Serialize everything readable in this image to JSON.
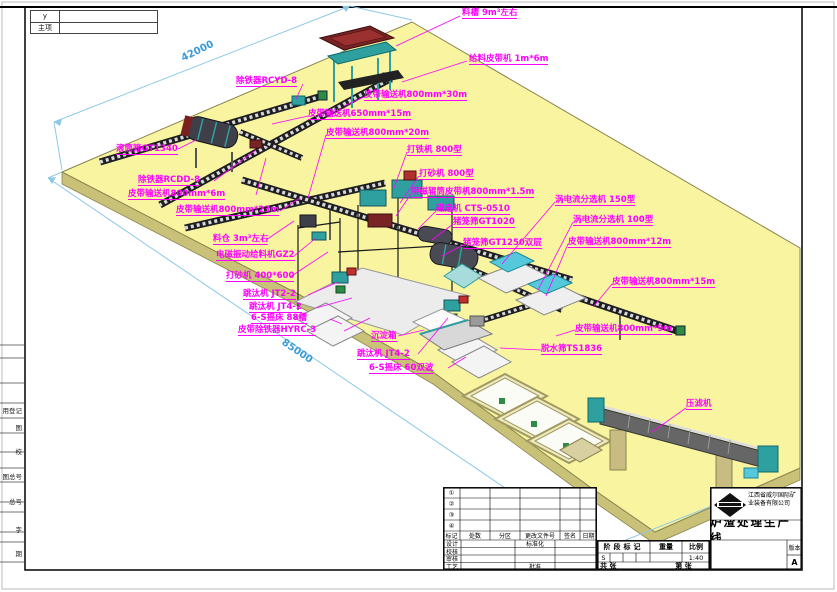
{
  "colors": {
    "platform": "#F8F4A0",
    "platform_edge": "#C9C178",
    "label": "#FF00FF",
    "dimension_text": "#3A9AD9",
    "dimension_line": "#8CC8E8",
    "machine_teal": "#2FA0A0",
    "machine_cyan": "#55C8DC",
    "machine_darkred": "#7A2525",
    "conveyor": "#1E1E22"
  },
  "corner_box": {
    "row1": "y",
    "row2": "主项"
  },
  "margin_fields": [
    {
      "text": "用登记",
      "y": 405
    },
    {
      "text": "图",
      "y": 422
    },
    {
      "text": "校",
      "y": 446
    },
    {
      "text": "图总号",
      "y": 471
    },
    {
      "text": "总号",
      "y": 496
    },
    {
      "text": "字",
      "y": 524
    },
    {
      "text": "期",
      "y": 548
    }
  ],
  "dimensions": {
    "top_edge": "42000",
    "bottom_edge": "85000"
  },
  "annotations": [
    {
      "name": "label-feed-trough",
      "text": "料槽 9m³左右",
      "x": 462,
      "y": 9
    },
    {
      "name": "label-feed-belt",
      "text": "给料皮带机 1m*6m",
      "x": 469,
      "y": 55
    },
    {
      "name": "label-iron-remover-rcyd8",
      "text": "除铁器RCYD-8",
      "x": 236,
      "y": 77
    },
    {
      "name": "label-belt-800-30",
      "text": "皮带输送机800mm*30m",
      "x": 364,
      "y": 91
    },
    {
      "name": "label-belt-650-15",
      "text": "皮带输送机650mm*15m",
      "x": 308,
      "y": 110
    },
    {
      "name": "label-belt-800-20",
      "text": "皮带输送机800mm*20m",
      "x": 326,
      "y": 129
    },
    {
      "name": "label-iron-beater-800",
      "text": "打铁机 800型",
      "x": 407,
      "y": 146
    },
    {
      "name": "label-sand-maker-800",
      "text": "打砂机 800型",
      "x": 419,
      "y": 170
    },
    {
      "name": "label-magnetic-roller-belt",
      "text": "带磁辊筒皮带机800mm*1.5m",
      "x": 411,
      "y": 188
    },
    {
      "name": "label-magnetic-separator",
      "text": "磁选机 CTS-0510",
      "x": 436,
      "y": 205
    },
    {
      "name": "label-cage-screen-1020",
      "text": "猪笼筛GT1020",
      "x": 453,
      "y": 218
    },
    {
      "name": "label-cage-screen-1250",
      "text": "猪笼筛GT1250双层",
      "x": 463,
      "y": 239
    },
    {
      "name": "label-eddy-150",
      "text": "涡电流分选机 150型",
      "x": 555,
      "y": 196
    },
    {
      "name": "label-eddy-100",
      "text": "涡电流分选机 100型",
      "x": 573,
      "y": 216
    },
    {
      "name": "label-belt-800-12",
      "text": "皮带输送机800mm*12m",
      "x": 568,
      "y": 238
    },
    {
      "name": "label-belt-800-15",
      "text": "皮带输送机800mm*15m",
      "x": 612,
      "y": 278
    },
    {
      "name": "label-belt-800-9",
      "text": "皮带输送机800mm*9m",
      "x": 575,
      "y": 325
    },
    {
      "name": "label-dewater-screen",
      "text": "脱水筛TS1836",
      "x": 541,
      "y": 345
    },
    {
      "name": "label-filter-press",
      "text": "压滤机",
      "x": 686,
      "y": 400
    },
    {
      "name": "label-trommel-1340",
      "text": "滚筒筛GT1340",
      "x": 116,
      "y": 145
    },
    {
      "name": "label-iron-remover-rcdd8",
      "text": "除铁器RCDD-8",
      "x": 138,
      "y": 176
    },
    {
      "name": "label-belt-800-6",
      "text": "皮带输送机800mm*6m",
      "x": 128,
      "y": 190
    },
    {
      "name": "label-belt-800-23",
      "text": "皮带输送机800mm*23m",
      "x": 176,
      "y": 206
    },
    {
      "name": "label-bin",
      "text": "料仓 3m³左右",
      "x": 213,
      "y": 235
    },
    {
      "name": "label-em-feeder",
      "text": "电磁振动给料机GZ2",
      "x": 216,
      "y": 251
    },
    {
      "name": "label-sand-maker-400",
      "text": "打砂机 400*600",
      "x": 226,
      "y": 272
    },
    {
      "name": "label-jig-jt22",
      "text": "跳汰机 JT2-2",
      "x": 243,
      "y": 290
    },
    {
      "name": "label-jig-jt42-a",
      "text": "跳汰机 JT4-2",
      "x": 249,
      "y": 303
    },
    {
      "name": "label-table-88",
      "text": "6-S摇床 88槽",
      "x": 251,
      "y": 314
    },
    {
      "name": "label-belt-iron-hyrc3",
      "text": "皮带除铁器HYRC-3",
      "x": 238,
      "y": 326
    },
    {
      "name": "label-settling-box",
      "text": "沉淀箱",
      "x": 371,
      "y": 332
    },
    {
      "name": "label-jig-jt42-b",
      "text": "跳汰机 JT4-2",
      "x": 357,
      "y": 350
    },
    {
      "name": "label-table-60",
      "text": "6-S摇床 60双波",
      "x": 369,
      "y": 364
    },
    {
      "name": "dim-42000",
      "text": "42000",
      "x": 180,
      "y": 55,
      "rot": -26,
      "type": "dim"
    },
    {
      "name": "dim-85000",
      "text": "85000",
      "x": 285,
      "y": 338,
      "rot": 34,
      "type": "dim"
    }
  ],
  "title_block": {
    "company": "江西省威尔国际矿业装备有限公司",
    "drawing_title": "炉渣处理生产线",
    "revision_header": [
      "标记",
      "处数",
      "分区",
      "更改文件号",
      "签名",
      "日期"
    ],
    "revision_symbols": [
      "①",
      "②",
      "③",
      "④"
    ],
    "sign_left": [
      "设计",
      "校核",
      "审核",
      "工艺"
    ],
    "standardization_label": "标准化",
    "approve_label": "批准",
    "stage_mark_label": "阶段标记",
    "weight_label": "重量",
    "scale_label": "比例",
    "stage_value": "S",
    "scale_value": "1:40",
    "sheets_total": "共 张",
    "sheet_number": "第 张",
    "version_label": "版本",
    "version_value": "A"
  }
}
